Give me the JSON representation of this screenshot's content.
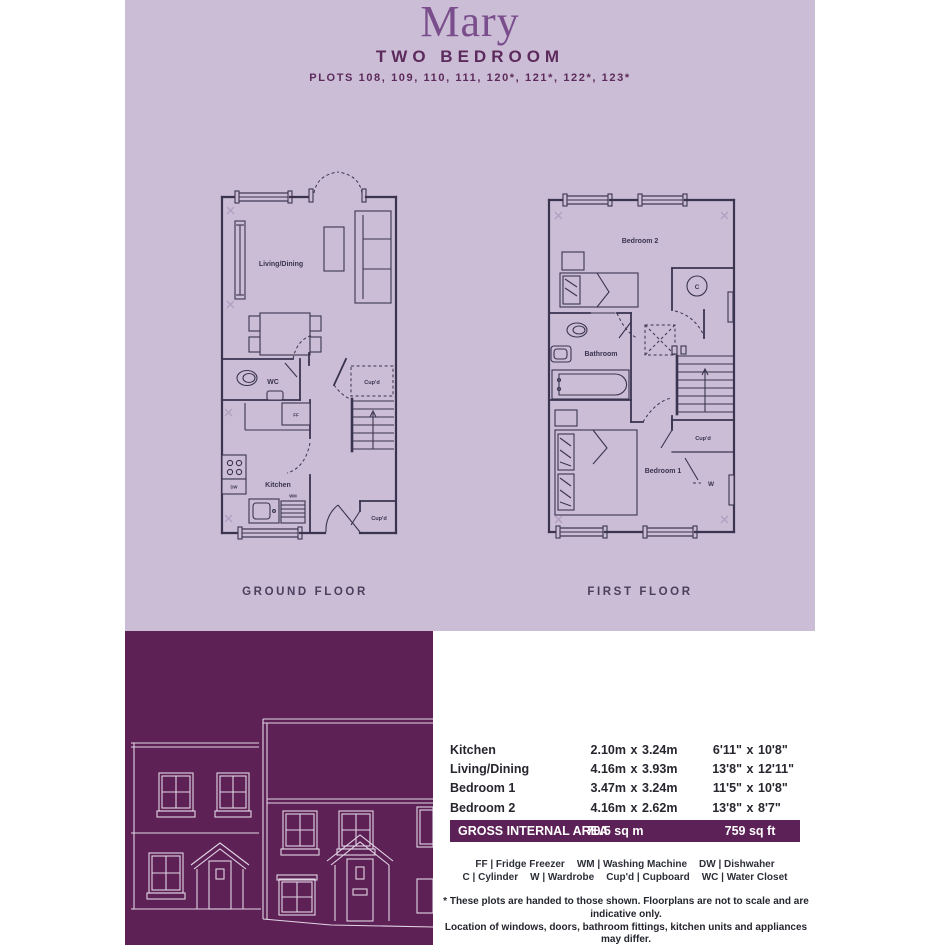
{
  "header": {
    "title": "Mary",
    "subtitle": "TWO BEDROOM",
    "plots": "PLOTS 108, 109, 110, 111, 120*, 121*, 122*, 123*"
  },
  "colors": {
    "lavender_bg": "#cbbdd5",
    "brand_purple": "#5e2156",
    "title_purple": "#7a4d8c",
    "plan_line": "#3a3450"
  },
  "floorplans": {
    "ground": {
      "caption": "GROUND FLOOR",
      "labels": {
        "living": "Living/Dining",
        "wc": "WC",
        "kitchen": "Kitchen",
        "cupd_stairs": "Cup'd",
        "cupd_hall": "Cup'd",
        "ff": "FF",
        "dw": "DW",
        "wm": "WM"
      }
    },
    "first": {
      "caption": "FIRST FLOOR",
      "labels": {
        "bedroom2": "Bedroom 2",
        "bathroom": "Bathroom",
        "bedroom1": "Bedroom 1",
        "cupd": "Cup'd",
        "cylinder": "C",
        "wardrobe": "W"
      }
    }
  },
  "dimensions_table": {
    "separator": "x",
    "rows": [
      {
        "room": "Kitchen",
        "m1": "2.10m",
        "m2": "3.24m",
        "i1": "6'11\"",
        "i2": "10'8\""
      },
      {
        "room": "Living/Dining",
        "m1": "4.16m",
        "m2": "3.93m",
        "i1": "13'8\"",
        "i2": "12'11\""
      },
      {
        "room": "Bedroom 1",
        "m1": "3.47m",
        "m2": "3.24m",
        "i1": "11'5\"",
        "i2": "10'8\""
      },
      {
        "room": "Bedroom 2",
        "m1": "4.16m",
        "m2": "2.62m",
        "i1": "13'8\"",
        "i2": "8'7\""
      }
    ],
    "total": {
      "label": "GROSS INTERNAL AREA",
      "metric": "70.5 sq m",
      "imperial": "759 sq ft"
    }
  },
  "legend": {
    "row1": [
      "FF | Fridge Freezer",
      "WM | Washing Machine",
      "DW | Dishwaher"
    ],
    "row2": [
      "C | Cylinder",
      "W | Wardrobe",
      "Cup'd | Cupboard",
      "WC | Water Closet"
    ]
  },
  "disclaimer": [
    "* These plots are handed to those shown. Floorplans are not to scale and are indicative only.",
    "Location of windows, doors, bathroom fittings, kitchen units and appliances may differ.",
    "Dimensions given are approximate and should not be used to order carpets or furniture.",
    "Wardrobe locations and sizes may differ."
  ]
}
